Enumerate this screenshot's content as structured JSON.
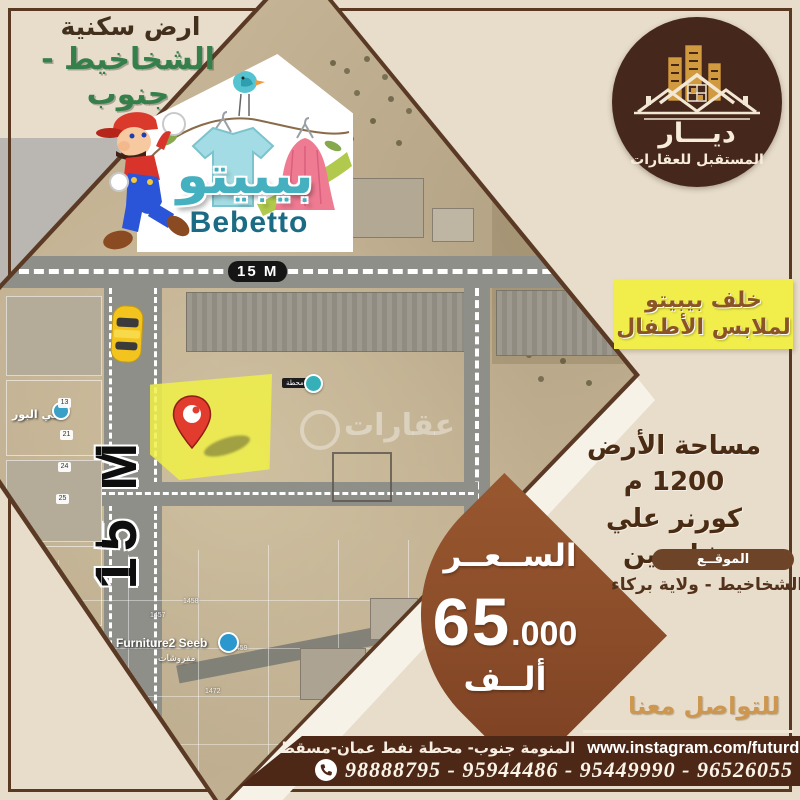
{
  "colors": {
    "background": "#e8ddcb",
    "frame": "#5a3922",
    "green": "#35804a",
    "brown": "#42301d",
    "highlight_yellow": "#f1ee4b",
    "price_sienna": "#8a4c29",
    "bar_brown": "#4e2817",
    "gold": "#cd9750",
    "bebetto_teal": "#45b0bf",
    "bebetto_dark_teal": "#1b6b84",
    "logo_circle": "#45271c",
    "logo_gold": "#d29a3f"
  },
  "top_left": {
    "line1": "ارض سكنية",
    "line2": "الشخاخيط - جنوب"
  },
  "bebetto": {
    "name_ar": "بيبيتو",
    "name_en": "Bebetto"
  },
  "logo": {
    "name": "ديـــار",
    "subtitle": "المستقبل للعقارات"
  },
  "highlight": {
    "line1": "خلف بيبيتو",
    "line2": "لملابس الأطفال"
  },
  "details": {
    "area_line": "مساحة الأرض 1200 م",
    "corner_line": "كورنر علي شارعين"
  },
  "location": {
    "label": "الموقــع",
    "value": "الشخاخيط - ولاية بركاء"
  },
  "price": {
    "label": "الســعــر",
    "big": "65",
    "small": ".000",
    "unit": "ألــف"
  },
  "contact": {
    "heading": "للتواصل معنا",
    "address": "المنومة جنوب- محطة نفط عمان-مسقط",
    "instagram": "www.instagram.com/futurdiyar",
    "phones": "98888795 - 95944486 - 95449990 - 96526055"
  },
  "map": {
    "road_label": "15 M",
    "street_label": "15 M",
    "district": "حي البور",
    "station": "محطة",
    "furniture_store": "Furniture2 Seeb",
    "furniture_store_ar": "مفروشات",
    "watermark": "عقارات",
    "plot_numbers": [
      "1456",
      "1457",
      "1458",
      "1459",
      "1472",
      "1473"
    ],
    "marker_numbers": [
      "13",
      "21",
      "24",
      "25"
    ]
  }
}
